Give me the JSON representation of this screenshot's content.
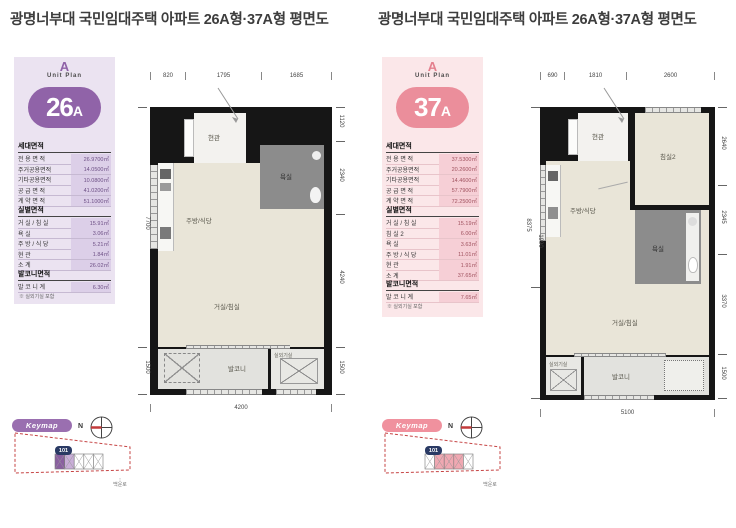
{
  "title": "광명너부대 국민임대주택 아파트 26A형·37A형 평면도",
  "left": {
    "accent": "#8F62A8",
    "logo_letter": "A",
    "logo_text": "Unit Plan",
    "unit_main": "26",
    "unit_suffix": "A",
    "household": {
      "header": "세대면적",
      "rows": [
        {
          "label": "전 용 면 적",
          "value": "26.9700㎡"
        },
        {
          "label": "주거공용면적",
          "value": "14.0500㎡"
        },
        {
          "label": "기타공용면적",
          "value": "10.0800㎡"
        },
        {
          "label": "공 급 면 적",
          "value": "41.0200㎡"
        },
        {
          "label": "계 약 면 적",
          "value": "51.1000㎡"
        }
      ]
    },
    "rooms_table": {
      "header": "실별면적",
      "rows": [
        {
          "label": "거 실 / 침 실",
          "value": "15.91㎡"
        },
        {
          "label": "욕            실",
          "value": "3.06㎡"
        },
        {
          "label": "주 방 / 식 당",
          "value": "5.21㎡"
        },
        {
          "label": "현            관",
          "value": "1.84㎡"
        },
        {
          "label": "소            계",
          "value": "26.02㎡"
        }
      ]
    },
    "balcony_table": {
      "header": "발코니면적",
      "rows": [
        {
          "label": "발 코 니 계",
          "value": "6.30㎡"
        }
      ]
    },
    "note": "※ 실외기실 포함",
    "plan": {
      "dims_top": [
        "820",
        "1795",
        "1685"
      ],
      "dim_bottom": "4200",
      "dims_right": [
        "1120",
        "2340",
        "4240",
        "1500"
      ],
      "dims_left": [
        "7700",
        "1500"
      ],
      "rooms": {
        "entrance": "현관",
        "kitchen": "주방/식당",
        "bath": "욕실",
        "living": "거실/침실",
        "balcony": "발코니",
        "ac": "실외기실"
      }
    },
    "keymap": {
      "label": "Keymap",
      "north": "N",
      "block": "101",
      "road": "백운로"
    }
  },
  "right": {
    "accent": "#EB8E9B",
    "logo_letter": "A",
    "logo_text": "Unit Plan",
    "unit_main": "37",
    "unit_suffix": "A",
    "household": {
      "header": "세대면적",
      "rows": [
        {
          "label": "전 용 면 적",
          "value": "37.5300㎡"
        },
        {
          "label": "주거공용면적",
          "value": "20.2600㎡"
        },
        {
          "label": "기타공용면적",
          "value": "14.4600㎡"
        },
        {
          "label": "공 급 면 적",
          "value": "57.7900㎡"
        },
        {
          "label": "계 약 면 적",
          "value": "72.2500㎡"
        }
      ]
    },
    "rooms_table": {
      "header": "실별면적",
      "rows": [
        {
          "label": "거 실 / 침 실",
          "value": "15.19㎡"
        },
        {
          "label": "침   실   2",
          "value": "6.00㎡"
        },
        {
          "label": "욕            실",
          "value": "3.63㎡"
        },
        {
          "label": "주 방 / 식 당",
          "value": "11.01㎡"
        },
        {
          "label": "현            관",
          "value": "1.91㎡"
        },
        {
          "label": "소            계",
          "value": "37.65㎡"
        }
      ]
    },
    "balcony_table": {
      "header": "발코니면적",
      "rows": [
        {
          "label": "발 코 니 계",
          "value": "7.65㎡"
        }
      ]
    },
    "note": "※ 실외기실 포함",
    "plan": {
      "dims_top": [
        "690",
        "1810",
        "2600"
      ],
      "dim_bottom": "5100",
      "dims_right": [
        "2640",
        "2345",
        "3370",
        "1500"
      ],
      "dims_left": [
        "8375",
        "1990"
      ],
      "rooms": {
        "entrance": "현관",
        "bedroom2": "침실2",
        "kitchen": "주방/식당",
        "bath": "욕실",
        "living": "거실/침실",
        "balcony": "발코니",
        "ac": "실외기실"
      }
    },
    "keymap": {
      "label": "Keymap",
      "north": "N",
      "block": "101",
      "road": "백운로"
    }
  }
}
